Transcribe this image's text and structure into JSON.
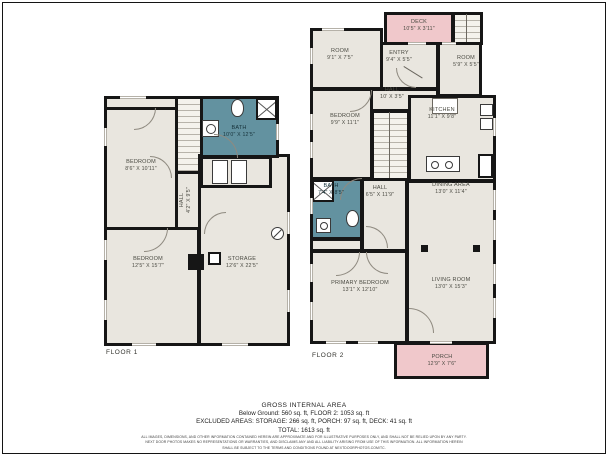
{
  "colors": {
    "wall": "#161616",
    "room_fill": "#e9e6df",
    "bath_fill": "#6392a0",
    "deck_fill": "#f0c8cb"
  },
  "floor1": {
    "caption": "FLOOR 1",
    "rooms": {
      "bedroom_top": {
        "name": "BEDROOM",
        "dims": "8'6\" X 10'11\""
      },
      "bath": {
        "name": "BATH",
        "dims": "10'0\" X 12'5\""
      },
      "hall": {
        "name": "HALL",
        "dims": "4'2\" X 9'5\""
      },
      "bedroom_bottom": {
        "name": "BEDROOM",
        "dims": "12'5\" X 15'7\""
      },
      "storage": {
        "name": "STORAGE",
        "dims": "12'6\" X 22'5\""
      }
    }
  },
  "floor2": {
    "caption": "FLOOR 2",
    "rooms": {
      "deck": {
        "name": "DECK",
        "dims": "10'5\" X 3'11\""
      },
      "room_left": {
        "name": "ROOM",
        "dims": "9'1\" X 7'5\""
      },
      "entry": {
        "name": "ENTRY",
        "dims": "9'4\" X 5'5\""
      },
      "room_right": {
        "name": "ROOM",
        "dims": "5'9\" X 5'5\""
      },
      "hall_upper": {
        "name": "HALL",
        "dims": "10' X 3'5\""
      },
      "bedroom": {
        "name": "BEDROOM",
        "dims": "9'9\" X 11'1\""
      },
      "kitchen": {
        "name": "KITCHEN",
        "dims": "11'1\" X 9'8\""
      },
      "bath": {
        "name": "BATH",
        "dims": "7'4\" X 8'5\""
      },
      "hall_lower": {
        "name": "HALL",
        "dims": "6'5\" X 11'9\""
      },
      "dining": {
        "name": "DINING AREA",
        "dims": "13'0\" X 11'4\""
      },
      "primary_bedroom": {
        "name": "PRIMARY BEDROOM",
        "dims": "13'1\" X 12'10\""
      },
      "living_room": {
        "name": "LIVING ROOM",
        "dims": "13'0\" X 15'3\""
      },
      "porch": {
        "name": "PORCH",
        "dims": "12'9\" X 7'6\""
      }
    }
  },
  "summary": {
    "title": "GROSS INTERNAL AREA",
    "line1": "Below Ground: 560 sq. ft, FLOOR 2: 1053 sq. ft",
    "line2": "EXCLUDED AREAS: STORAGE: 266 sq. ft, PORCH: 97 sq. ft, DECK: 41 sq. ft",
    "line3": "TOTAL: 1613 sq. ft",
    "disclaimer1": "ALL IMAGES, DIMENSIONS, AND OTHER INFORMATION CONTAINED HEREIN ARE APPROXIMATE AND FOR ILLUSTRATIVE PURPOSES ONLY, AND SHALL NOT BE RELIED UPON BY ANY PARTY.",
    "disclaimer2": "NEXT DOOR PHOTOS MAKES NO REPRESENTATIONS OR WARRANTIES, AND DISCLAIMS ANY AND ALL LIABILITY ARISING FROM USE OF THIS INFORMATION. ALL INFORMATION HEREIN",
    "disclaimer3": "SHALL BE SUBJECT TO THE TERMS AND CONDITIONS FOUND AT NEXTDOORPHOTOS.COM/TC."
  }
}
